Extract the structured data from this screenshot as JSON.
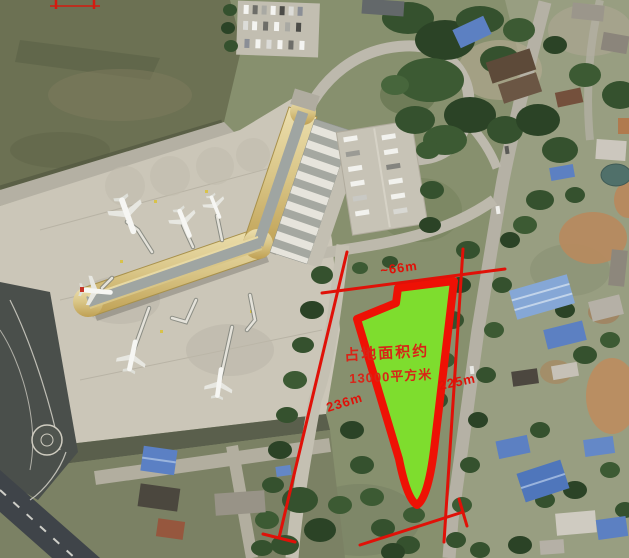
{
  "scene": {
    "type": "satellite-aerial-photo-with-site-annotation",
    "subject": "airport-terminal-and-adjacent-land-parcel",
    "parcel": {
      "area_text_line1": "占地面积约",
      "area_text_line2": "13000平方米",
      "fill_color": "#7edd2e",
      "outline_color": "#ee1105"
    },
    "measurements": {
      "top": "~66m",
      "left": "236m",
      "right": "225m"
    },
    "annotation_color": "#e01108"
  }
}
